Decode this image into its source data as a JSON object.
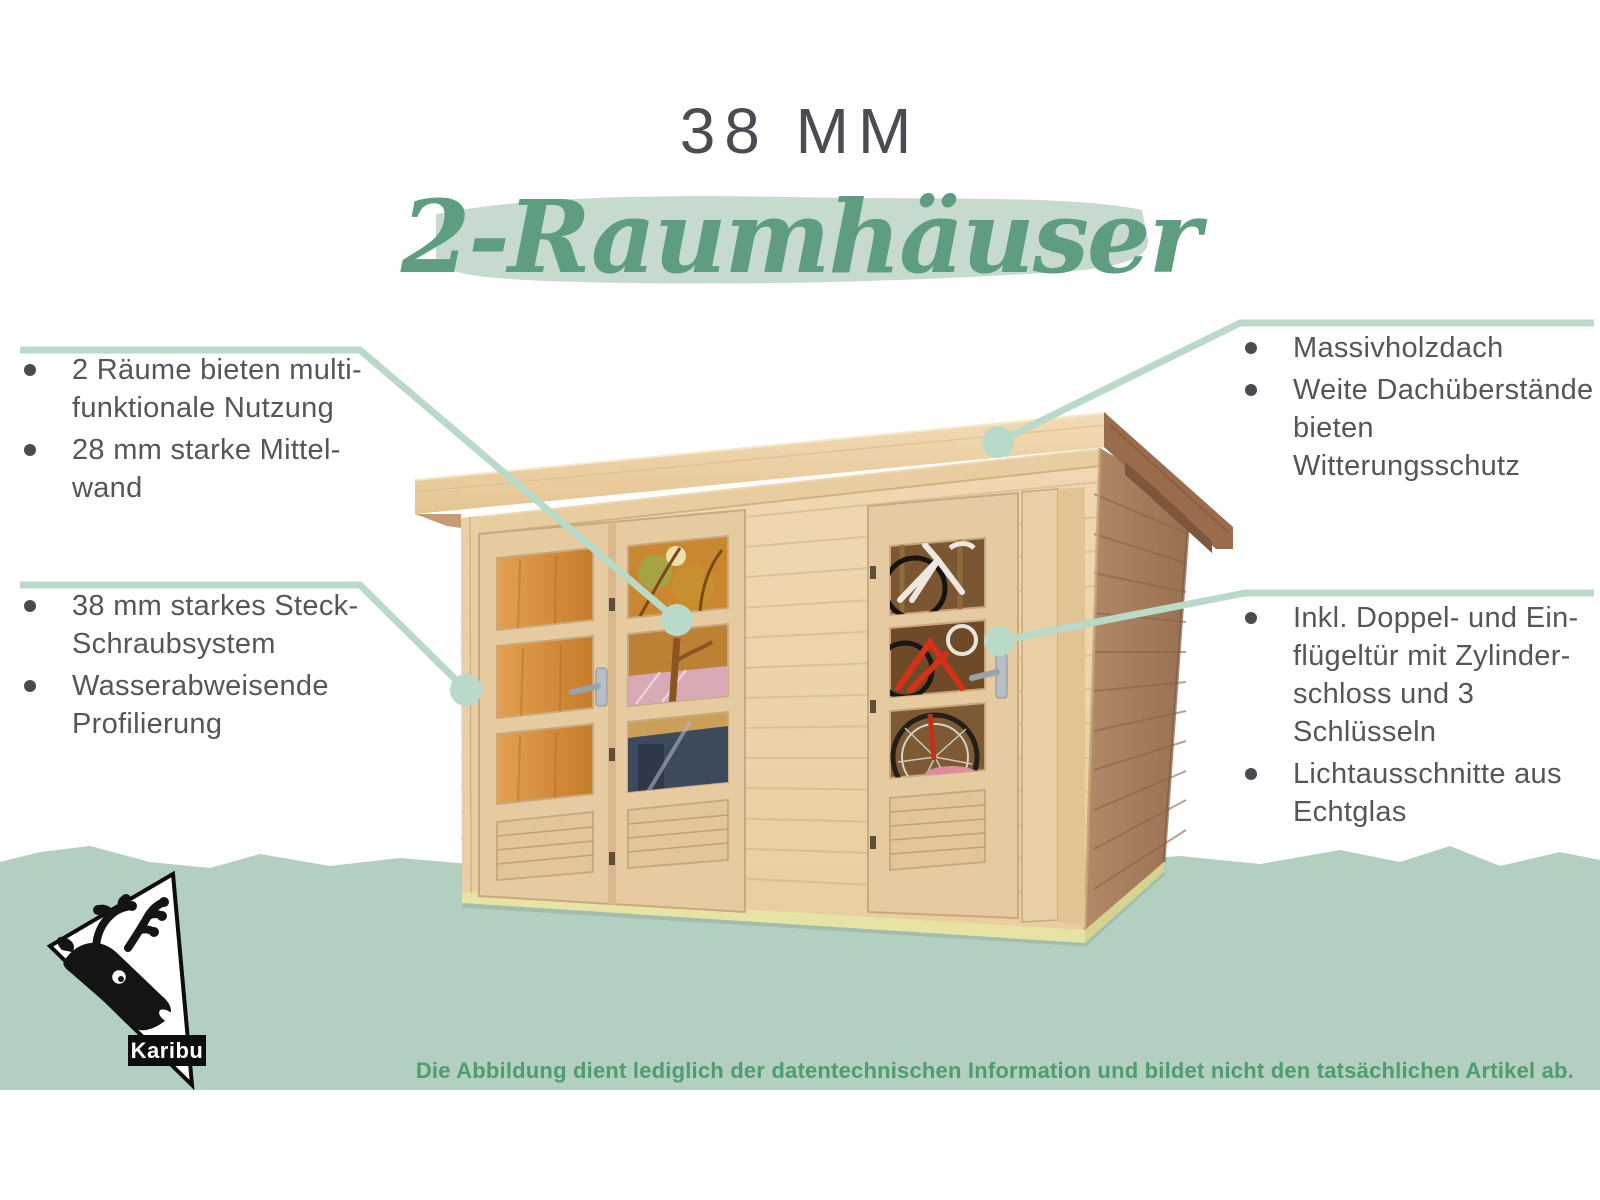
{
  "header": {
    "size_label": "38 MM",
    "product_line": "2-Raumhäuser"
  },
  "notes": {
    "top_left": {
      "items": [
        [
          "2 Räume bieten multi-",
          "funktionale Nutzung"
        ],
        [
          "28 mm starke Mittel-",
          "wand"
        ]
      ]
    },
    "bottom_left": {
      "items": [
        [
          "38 mm starkes Steck-",
          "Schraubsystem"
        ],
        [
          "Wasserabweisende",
          "Profilierung"
        ]
      ]
    },
    "top_right": {
      "items": [
        [
          "Massivholzdach"
        ],
        [
          "Weite Dachüberstände",
          "bieten Witterungsschutz"
        ]
      ]
    },
    "bottom_right": {
      "items": [
        [
          "Inkl. Doppel- und Ein-",
          "flügeltür mit Zylinder-",
          "schloss und 3",
          "Schlüsseln"
        ],
        [
          "Lichtausschnitte aus",
          "Echtglas"
        ]
      ]
    }
  },
  "footer": {
    "disclaimer": "Die Abbildung dient lediglich der datentechnischen Information und bildet nicht den tatsächlichen Artikel ab."
  },
  "logo": {
    "brand": "Karibu"
  },
  "colors": {
    "band_green": "#b2cfc0",
    "brush_green": "#c6dbce",
    "headline_green": "#5e9d7f",
    "disclaimer_green": "#4f9c70",
    "title_gray": "#4b4b53",
    "body_gray": "#55555b",
    "connector_mint": "#b9d9c9",
    "wood_light": "#eed5ac",
    "wood_dark": "#aa8263",
    "base_strip": "#e7e3a4",
    "bike_red": "#d63018"
  }
}
